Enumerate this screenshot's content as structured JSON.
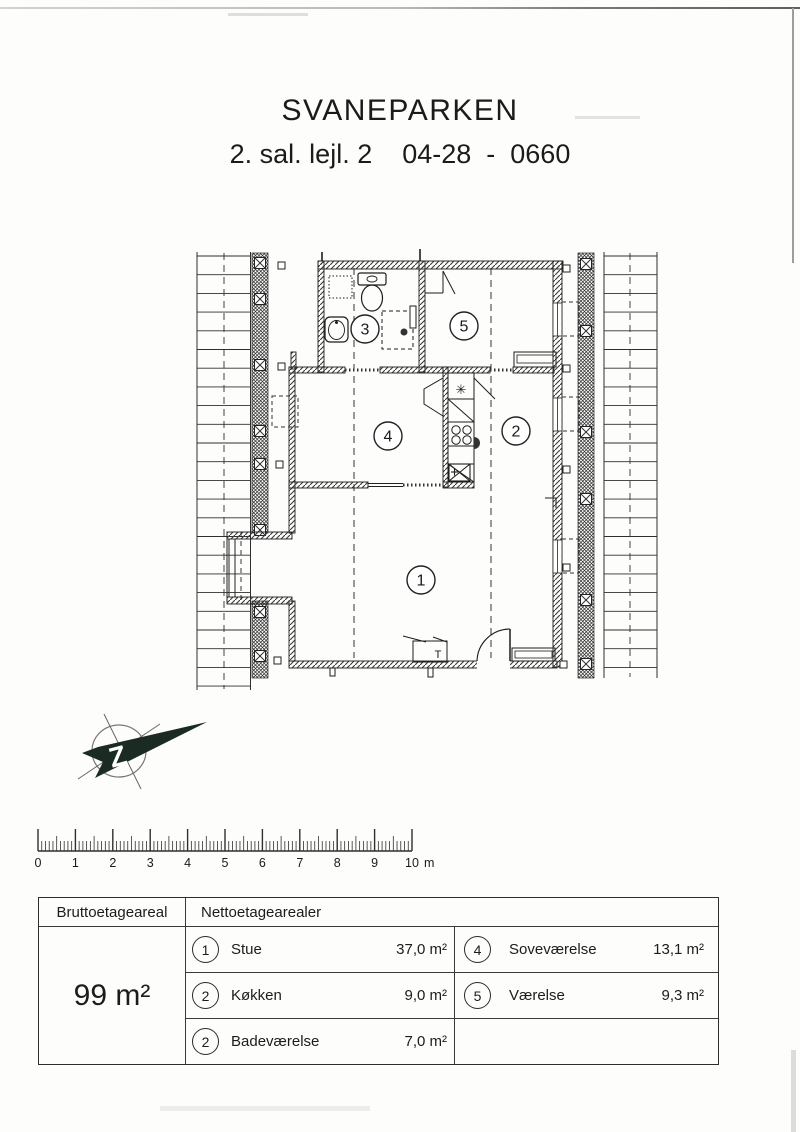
{
  "page": {
    "title": "SVANEPARKEN",
    "subtitle": "2. sal. lejl. 2    04-28  -  0660"
  },
  "floorplan": {
    "rooms": [
      {
        "number": "1"
      },
      {
        "number": "2"
      },
      {
        "number": "3"
      },
      {
        "number": "4"
      },
      {
        "number": "5"
      }
    ],
    "t_label": "T",
    "vent_symbol": "✳"
  },
  "north_arrow": {
    "letter": "Z"
  },
  "scale_bar": {
    "labels": [
      "0",
      "1",
      "2",
      "3",
      "4",
      "5",
      "6",
      "7",
      "8",
      "9",
      "10"
    ],
    "unit": "m"
  },
  "table": {
    "brutto_header": "Bruttoetageareal",
    "brutto_value": "99 m²",
    "netto_header": "Nettoetagearealer",
    "rows_col1": [
      {
        "num": "1",
        "name": "Stue",
        "area": "37,0 m²"
      },
      {
        "num": "2",
        "name": "Køkken",
        "area": "9,0 m²"
      },
      {
        "num": "2",
        "name": "Badeværelse",
        "area": "7,0 m²"
      }
    ],
    "rows_col2": [
      {
        "num": "4",
        "name": "Soveværelse",
        "area": "13,1 m²"
      },
      {
        "num": "5",
        "name": "Værelse",
        "area": "9,3 m²"
      }
    ]
  }
}
